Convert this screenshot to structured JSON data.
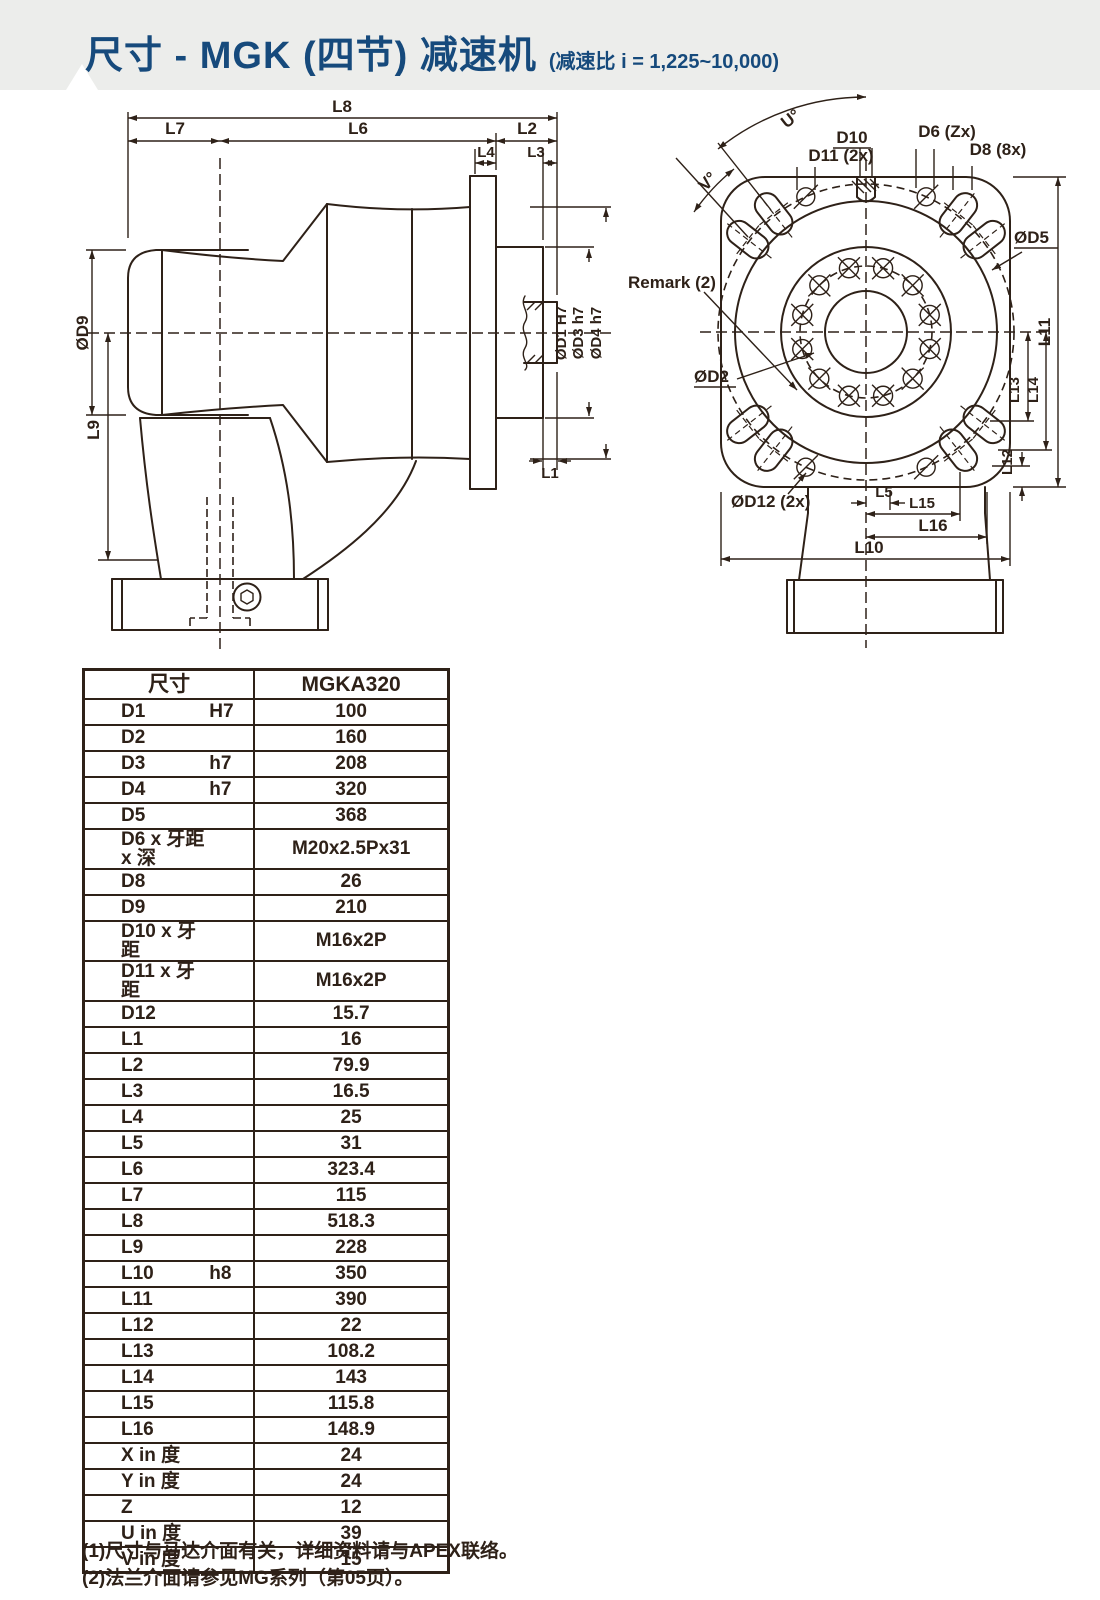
{
  "page": {
    "line_color": "#2e2118",
    "accent_color": "#164a7c",
    "header_bg": "#ecedeb"
  },
  "header": {
    "title": "尺寸 - MGK (四节) 减速机",
    "subtitle": "(减速比 i = 1,225~10,000)"
  },
  "side_view": {
    "labels": {
      "l8": "L8",
      "l7": "L7",
      "l6": "L6",
      "l2": "L2",
      "l4": "L4",
      "l3": "L3",
      "d9": "ØD9",
      "l9": "L9",
      "l1": "L1",
      "d1": "ØD1 H7",
      "d3": "ØD3 h7",
      "d4": "ØD4 h7"
    }
  },
  "front_view": {
    "labels": {
      "u": "U°",
      "v": "V°",
      "d10": "D10",
      "d11": "D11 (2x)",
      "d6": "D6 (Zx)",
      "d8": "D8 (8x)",
      "d5": "ØD5",
      "remark": "Remark (2)",
      "d2": "ØD2",
      "d12": "ØD12 (2x)",
      "l5": "L5",
      "l15": "L15",
      "l16": "L16",
      "l10": "L10",
      "l11": "L11",
      "l13": "L13",
      "l14": "L14",
      "l12": "L12"
    }
  },
  "table": {
    "headers": {
      "dim": "尺寸",
      "model": "MGKA320"
    },
    "rows": [
      {
        "name": "D1",
        "tol": "H7",
        "value": "100"
      },
      {
        "name": "D2",
        "tol": "",
        "value": "160"
      },
      {
        "name": "D3",
        "tol": "h7",
        "value": "208"
      },
      {
        "name": "D4",
        "tol": "h7",
        "value": "320"
      },
      {
        "name": "D5",
        "tol": "",
        "value": "368"
      },
      {
        "name": "D6 x 牙距 x 深",
        "tol": "",
        "value": "M20x2.5Px31"
      },
      {
        "name": "D8",
        "tol": "",
        "value": "26"
      },
      {
        "name": "D9",
        "tol": "",
        "value": "210"
      },
      {
        "name": "D10 x 牙距",
        "tol": "",
        "value": "M16x2P"
      },
      {
        "name": "D11 x 牙距",
        "tol": "",
        "value": "M16x2P"
      },
      {
        "name": "D12",
        "tol": "",
        "value": "15.7"
      },
      {
        "name": "L1",
        "tol": "",
        "value": "16"
      },
      {
        "name": "L2",
        "tol": "",
        "value": "79.9"
      },
      {
        "name": "L3",
        "tol": "",
        "value": "16.5"
      },
      {
        "name": "L4",
        "tol": "",
        "value": "25"
      },
      {
        "name": "L5",
        "tol": "",
        "value": "31"
      },
      {
        "name": "L6",
        "tol": "",
        "value": "323.4"
      },
      {
        "name": "L7",
        "tol": "",
        "value": "115"
      },
      {
        "name": "L8",
        "tol": "",
        "value": "518.3"
      },
      {
        "name": "L9",
        "tol": "",
        "value": "228"
      },
      {
        "name": "L10",
        "tol": "h8",
        "value": "350"
      },
      {
        "name": "L11",
        "tol": "",
        "value": "390"
      },
      {
        "name": "L12",
        "tol": "",
        "value": "22",
        "dashed_top": true
      },
      {
        "name": "L13",
        "tol": "",
        "value": "108.2"
      },
      {
        "name": "L14",
        "tol": "",
        "value": "143"
      },
      {
        "name": "L15",
        "tol": "",
        "value": "115.8"
      },
      {
        "name": "L16",
        "tol": "",
        "value": "148.9"
      },
      {
        "name": "X in 度",
        "tol": "",
        "value": "24"
      },
      {
        "name": "Y in 度",
        "tol": "",
        "value": "24"
      },
      {
        "name": "Z",
        "tol": "",
        "value": "12"
      },
      {
        "name": "U in 度",
        "tol": "",
        "value": "39"
      },
      {
        "name": "V in 度",
        "tol": "",
        "value": "15"
      }
    ]
  },
  "notes": [
    "(1)尺寸与马达介面有关，详细资料请与APEX联络。",
    "(2)法兰介面请参见MG系列（第05页）。"
  ]
}
